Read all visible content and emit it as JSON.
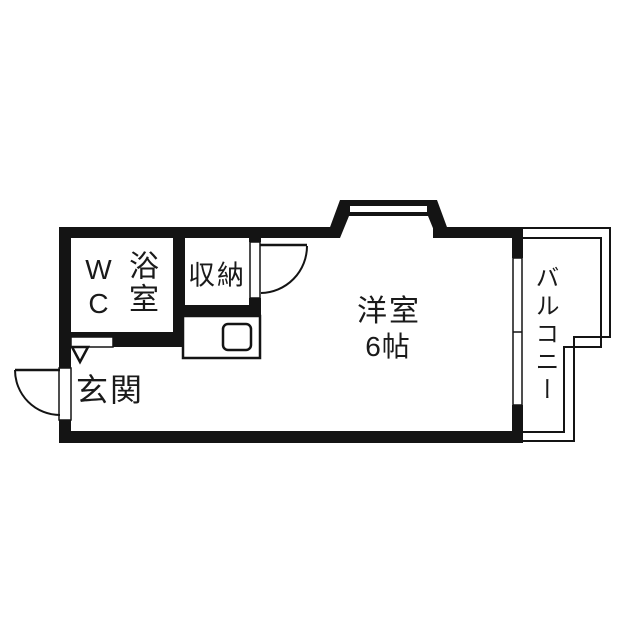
{
  "floorplan": {
    "type": "apartment-floor-plan",
    "rooms": {
      "toilet": {
        "label": "WC"
      },
      "bath": {
        "label": "浴室"
      },
      "closet": {
        "label": "収納"
      },
      "western_room": {
        "label": "洋室",
        "size_label": "6帖"
      },
      "entrance": {
        "label": "玄関"
      },
      "balcony": {
        "label": "バルコニー"
      }
    },
    "colors": {
      "wall": "#141414",
      "background": "#ffffff",
      "text": "#1a1a1a"
    }
  }
}
